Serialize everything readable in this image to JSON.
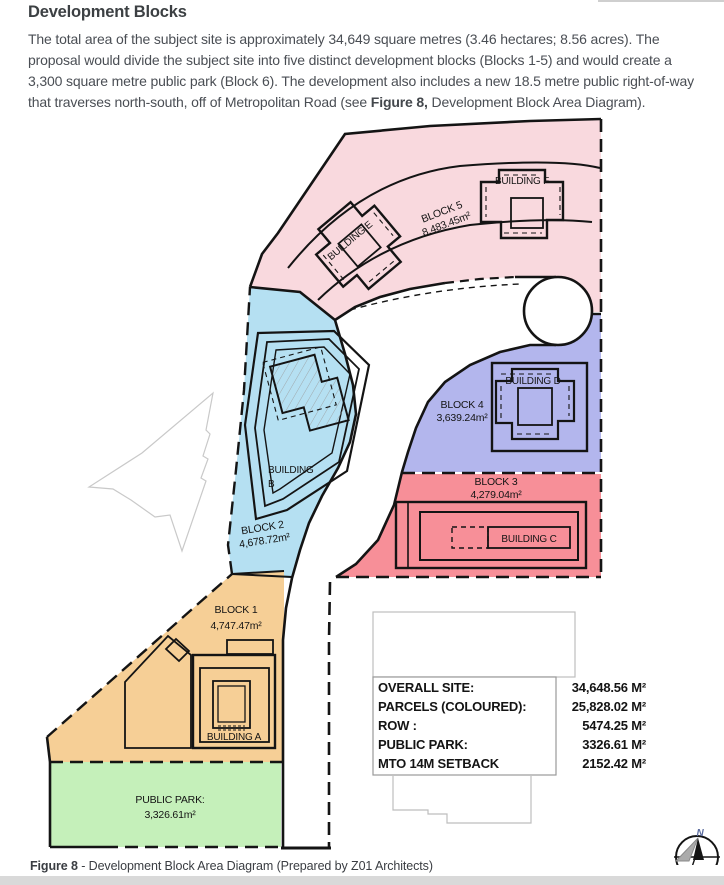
{
  "page": {
    "heading": "Development Blocks",
    "para_before": "The total area of the subject site is approximately 34,649 square metres (3.46 hectares; 8.56 acres). The proposal would divide the subject site into five distinct development blocks (Blocks 1-5) and would create a 3,300 square metre public park (Block 6). The development also includes a new 18.5 metre public right-of-way that traverses north-south, off of Metropolitan Road (see ",
    "para_bold": "Figure 8,",
    "para_after": " Development Block Area Diagram).",
    "caption_bold": "Figure 8",
    "caption_rest": " - Development Block Area Diagram (Prepared by Z01 Architects)"
  },
  "diagram": {
    "blocks": [
      {
        "label": "BLOCK 5",
        "area": "8,483.45m²",
        "color": "#f9d9de"
      },
      {
        "label": "BLOCK 2",
        "area": "4,678.72m²",
        "color": "#b5e0f2"
      },
      {
        "label": "BLOCK 4",
        "area": "3,639.24m²",
        "color": "#b3b6ed"
      },
      {
        "label": "BLOCK 3",
        "area": "4,279.04m²",
        "color": "#f78f98"
      },
      {
        "label": "BLOCK 1",
        "area": "4,747.47m²",
        "color": "#f6cf96"
      },
      {
        "label": "PUBLIC PARK:",
        "area": "3,326.61m²",
        "color": "#c5f0ba"
      }
    ],
    "buildings": {
      "a": "BUILDING A",
      "b_line1": "BUILDING",
      "b_line2": "B",
      "c": "BUILDING C",
      "d": "BUILDING D",
      "e": "BUILDING E",
      "f": "BUILDING F"
    },
    "table": {
      "rows": [
        {
          "label": "OVERALL SITE:",
          "value": "34,648.56 M²"
        },
        {
          "label": "PARCELS (COLOURED):",
          "value": "25,828.02 M²"
        },
        {
          "label": "ROW :",
          "value": "5474.25 M²"
        },
        {
          "label": "PUBLIC PARK:",
          "value": "3326.61 M²"
        },
        {
          "label": "MTO 14M SETBACK",
          "value": "2152.42 M²"
        }
      ]
    },
    "compass_label": "N"
  }
}
